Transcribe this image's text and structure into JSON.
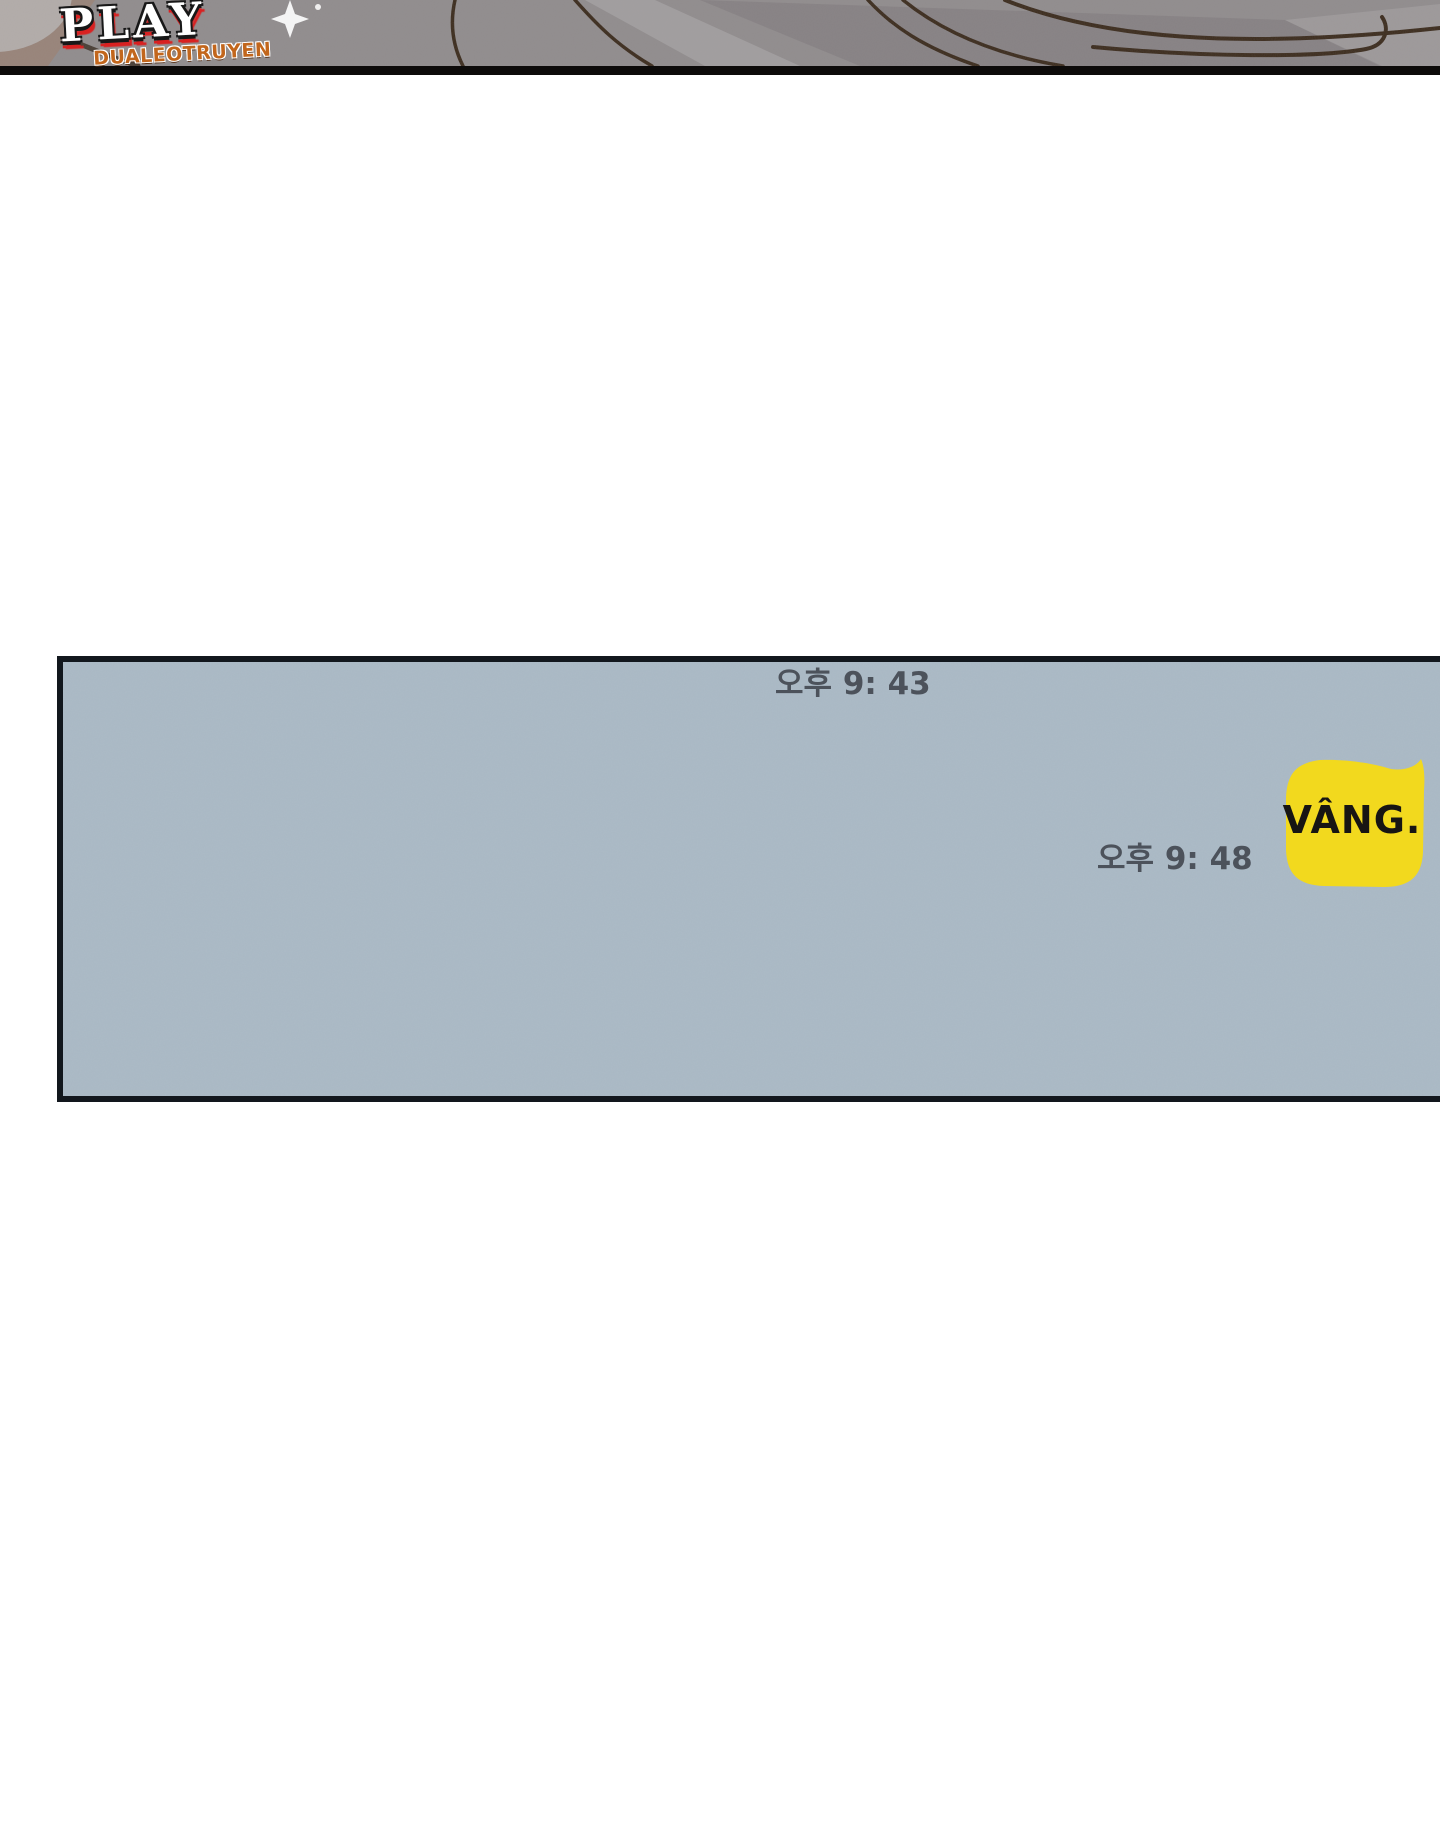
{
  "page": {
    "width": 1440,
    "height": 1822,
    "background_color": "#ffffff"
  },
  "watermark": {
    "title": "PLAY",
    "subtitle": "DUALEOTRUYEN",
    "title_color": "#ffffff",
    "title_outline_color": "#181818",
    "title_shadow_color": "#d92121",
    "subtitle_color": "#c2661c"
  },
  "comic_strip": {
    "background_color": "#918d8e",
    "border_color": "#0d0b0a",
    "line_color": "#3a2a1b"
  },
  "chat_panel": {
    "background_color": "#a9b8c4",
    "border_color": "#12171d",
    "timestamp_color": "#4c525b",
    "timestamps": [
      {
        "text": "오후 9: 43"
      },
      {
        "text": "오후 9: 48"
      }
    ],
    "message": {
      "text": "VÂNG.",
      "bubble_color": "#f2d91e",
      "text_color": "#171513",
      "align": "right"
    }
  }
}
